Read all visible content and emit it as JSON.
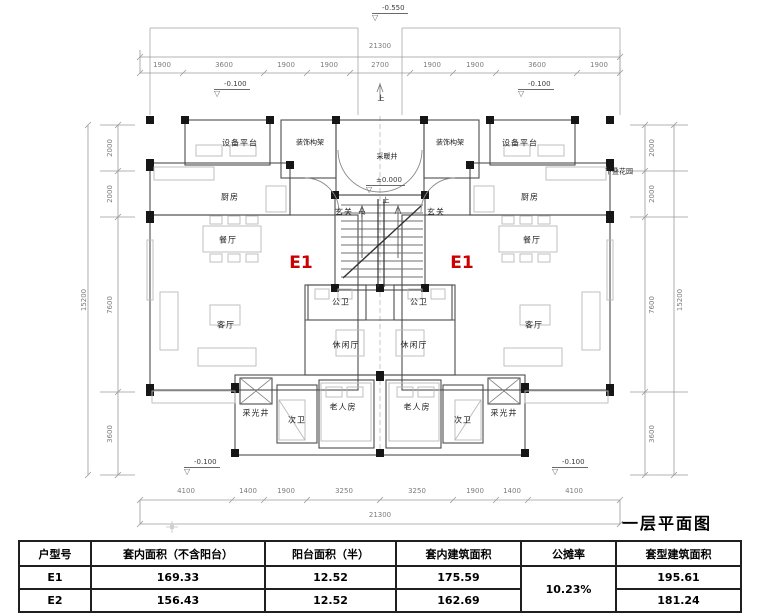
{
  "title": "一层平面图",
  "plan": {
    "unit_label": "E1",
    "rooms": {
      "equip": "设备平台",
      "deco": "装饰构架",
      "heat": "采暖井",
      "kitchen": "厨房",
      "foyer": "玄关",
      "garden": "下叠花园",
      "dining": "餐厅",
      "living": "客厅",
      "pbath": "公卫",
      "leisure": "休闲厅",
      "lwell": "采光井",
      "sbath": "次卫",
      "elder": "老人房"
    },
    "stair": {
      "up": "上",
      "down": "下"
    },
    "levels": {
      "entry_top": "-0.550",
      "side": "-0.100",
      "zero": "±0.000"
    },
    "dims": {
      "top_total": "21300",
      "top": [
        "1900",
        "3600",
        "1900",
        "1900",
        "2700",
        "1900",
        "1900",
        "3600",
        "1900"
      ],
      "bottom": [
        "4100",
        "1400",
        "1900",
        "3250",
        "3250",
        "1900",
        "1400",
        "4100"
      ],
      "bottom_total": "21300",
      "left": [
        "2000",
        "2000",
        "7600",
        "3600"
      ],
      "left_total": "15200",
      "right": [
        "2000",
        "2000",
        "7600",
        "3600"
      ],
      "right_total": "15200"
    }
  },
  "table": {
    "headers": [
      "户型号",
      "套内面积（不含阳台）",
      "阳台面积（半）",
      "套内建筑面积",
      "公摊率",
      "套型建筑面积"
    ],
    "rows": [
      {
        "type": "E1",
        "inner": "169.33",
        "balcony": "12.52",
        "inner_total": "175.59",
        "total": "195.61"
      },
      {
        "type": "E2",
        "inner": "156.43",
        "balcony": "12.52",
        "inner_total": "162.69",
        "total": "181.24"
      }
    ],
    "shared_rate": "10.23%"
  },
  "colors": {
    "unit_label": "#cc0000",
    "wall": "#161616",
    "line": "#8c8c8c"
  }
}
